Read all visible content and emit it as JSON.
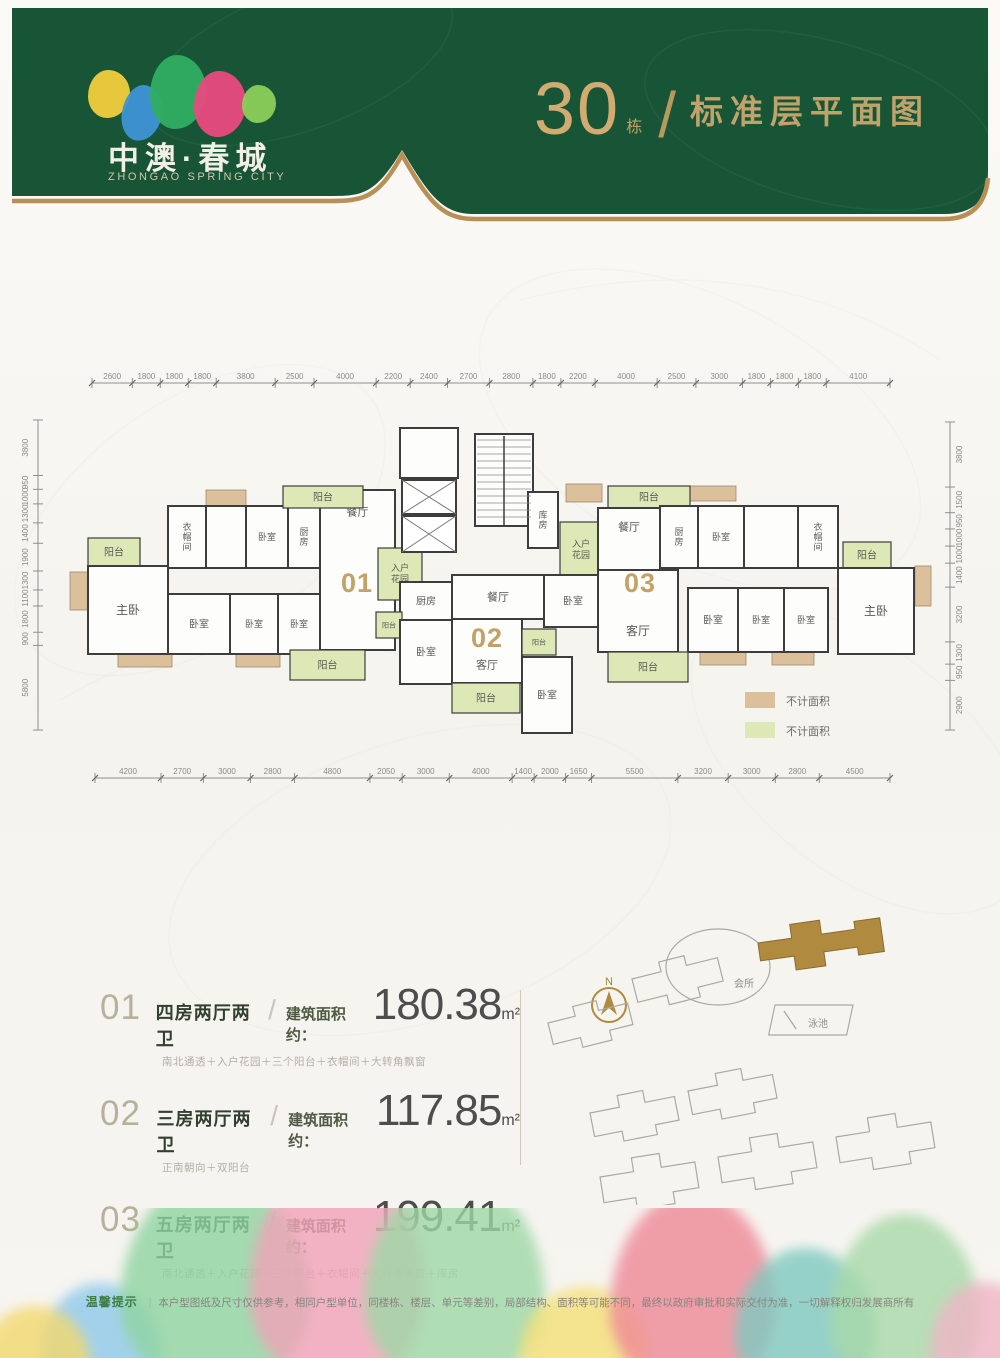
{
  "header": {
    "brand_cn": "中澳·春城",
    "brand_en": "ZHONGAO SPRING CITY",
    "building_number": "30",
    "building_suffix": "栋",
    "slash": "/",
    "page_title": "标准层平面图",
    "bg_color": "#175536",
    "gold_color": "#b89055",
    "leaf_colors": [
      "#f2cf3e",
      "#3e93d6",
      "#2fae62",
      "#e94a80",
      "#8ccf5a"
    ]
  },
  "plan": {
    "colors": {
      "tan": "#dcc09c",
      "green": "#dde8b6",
      "room": "#fdfdfb",
      "wall": "#3d3d3d",
      "dim": "#8f8f8f",
      "gold": "#c2a267"
    },
    "top_dims": [
      "2600",
      "1800",
      "1800",
      "1800",
      "3800",
      "2500",
      "4000",
      "2200",
      "2400",
      "2700",
      "2800",
      "1800",
      "2200",
      "4000",
      "2500",
      "3000",
      "1800",
      "1800",
      "1800",
      "4100"
    ],
    "bottom_dims": [
      "4200",
      "2700",
      "3000",
      "2800",
      "4800",
      "2050",
      "3000",
      "4000",
      "1400",
      "2000",
      "1650",
      "5500",
      "3200",
      "3000",
      "2800",
      "4500"
    ],
    "left_dims": [
      "3800",
      "950",
      "1000",
      "1300",
      "1400",
      "1900",
      "1300",
      "1100",
      "1800",
      "900",
      "5800"
    ],
    "right_dims": [
      "3800",
      "1500",
      "950",
      "1000",
      "1000",
      "1400",
      "3200",
      "1300",
      "950",
      "2900"
    ],
    "unit_numbers": [
      {
        "label": "01",
        "x": 357,
        "y": 232
      },
      {
        "label": "02",
        "x": 487,
        "y": 287
      },
      {
        "label": "03",
        "x": 640,
        "y": 232
      }
    ],
    "rooms": [
      {
        "x": 88,
        "y": 178,
        "w": 52,
        "h": 28,
        "f": "green",
        "label": "阳台",
        "fs": 10
      },
      {
        "x": 88,
        "y": 206,
        "w": 80,
        "h": 88,
        "f": "room",
        "label": "主卧",
        "fs": 12
      },
      {
        "x": 168,
        "y": 146,
        "w": 38,
        "h": 62,
        "f": "room",
        "label": "衣帽间",
        "fs": 9,
        "vert": true
      },
      {
        "x": 206,
        "y": 146,
        "w": 40,
        "h": 62,
        "f": "room"
      },
      {
        "x": 246,
        "y": 146,
        "w": 42,
        "h": 62,
        "f": "room",
        "label": "卧室",
        "fs": 9
      },
      {
        "x": 288,
        "y": 146,
        "w": 32,
        "h": 62,
        "f": "room",
        "label": "厨房",
        "fs": 9,
        "vert": true
      },
      {
        "x": 320,
        "y": 130,
        "w": 75,
        "h": 160,
        "f": "room",
        "label": "餐厅",
        "fs": 11,
        "ly": -58
      },
      {
        "x": 283,
        "y": 126,
        "w": 80,
        "h": 22,
        "f": "green",
        "label": "阳台",
        "fs": 10
      },
      {
        "x": 168,
        "y": 234,
        "w": 62,
        "h": 60,
        "f": "room",
        "label": "卧室",
        "fs": 10
      },
      {
        "x": 230,
        "y": 234,
        "w": 48,
        "h": 60,
        "f": "room",
        "label": "卧室",
        "fs": 9
      },
      {
        "x": 278,
        "y": 234,
        "w": 42,
        "h": 60,
        "f": "room",
        "label": "卧室",
        "fs": 9
      },
      {
        "x": 290,
        "y": 290,
        "w": 75,
        "h": 30,
        "f": "green",
        "label": "阳台",
        "fs": 10
      },
      {
        "x": 400,
        "y": 68,
        "w": 58,
        "h": 50,
        "f": "room"
      },
      {
        "x": 475,
        "y": 74,
        "w": 58,
        "h": 92,
        "f": "room"
      },
      {
        "x": 528,
        "y": 132,
        "w": 30,
        "h": 56,
        "f": "room",
        "label": "库房",
        "fs": 9,
        "vert": true
      },
      {
        "x": 378,
        "y": 188,
        "w": 44,
        "h": 52,
        "f": "green",
        "label": "入户花园",
        "fs": 9,
        "wrap": 2
      },
      {
        "x": 560,
        "y": 162,
        "w": 42,
        "h": 56,
        "f": "green",
        "label": "入户花园",
        "fs": 9,
        "wrap": 2
      },
      {
        "x": 400,
        "y": 222,
        "w": 52,
        "h": 38,
        "f": "room",
        "label": "厨房",
        "fs": 10
      },
      {
        "x": 376,
        "y": 252,
        "w": 26,
        "h": 26,
        "f": "green",
        "label": "阳台",
        "fs": 7
      },
      {
        "x": 452,
        "y": 215,
        "w": 92,
        "h": 44,
        "f": "room",
        "label": "餐厅",
        "fs": 11
      },
      {
        "x": 544,
        "y": 215,
        "w": 58,
        "h": 52,
        "f": "room",
        "label": "卧室",
        "fs": 10
      },
      {
        "x": 452,
        "y": 259,
        "w": 70,
        "h": 64,
        "f": "room",
        "label": "客厅",
        "fs": 11,
        "ly": 14
      },
      {
        "x": 400,
        "y": 260,
        "w": 52,
        "h": 64,
        "f": "room",
        "label": "卧室",
        "fs": 10
      },
      {
        "x": 452,
        "y": 323,
        "w": 68,
        "h": 30,
        "f": "green",
        "label": "阳台",
        "fs": 10
      },
      {
        "x": 522,
        "y": 297,
        "w": 50,
        "h": 76,
        "f": "room",
        "label": "卧室",
        "fs": 10
      },
      {
        "x": 522,
        "y": 269,
        "w": 34,
        "h": 26,
        "f": "green",
        "label": "阳台",
        "fs": 7
      },
      {
        "x": 608,
        "y": 126,
        "w": 82,
        "h": 22,
        "f": "green",
        "label": "阳台",
        "fs": 10
      },
      {
        "x": 598,
        "y": 148,
        "w": 62,
        "h": 62,
        "f": "room",
        "label": "餐厅",
        "fs": 11,
        "ly": -12
      },
      {
        "x": 660,
        "y": 146,
        "w": 38,
        "h": 62,
        "f": "room",
        "label": "厨房",
        "fs": 9,
        "vert": true
      },
      {
        "x": 698,
        "y": 146,
        "w": 46,
        "h": 62,
        "f": "room",
        "label": "卧室",
        "fs": 9
      },
      {
        "x": 744,
        "y": 146,
        "w": 54,
        "h": 62,
        "f": "room"
      },
      {
        "x": 798,
        "y": 146,
        "w": 40,
        "h": 62,
        "f": "room",
        "label": "衣帽间",
        "fs": 9,
        "vert": true
      },
      {
        "x": 598,
        "y": 210,
        "w": 80,
        "h": 82,
        "f": "room",
        "label": "客厅",
        "fs": 12,
        "ly": 20
      },
      {
        "x": 688,
        "y": 228,
        "w": 50,
        "h": 64,
        "f": "room",
        "label": "卧室",
        "fs": 10
      },
      {
        "x": 738,
        "y": 228,
        "w": 46,
        "h": 64,
        "f": "room",
        "label": "卧室",
        "fs": 9
      },
      {
        "x": 784,
        "y": 228,
        "w": 44,
        "h": 64,
        "f": "room",
        "label": "卧室",
        "fs": 9
      },
      {
        "x": 608,
        "y": 292,
        "w": 80,
        "h": 30,
        "f": "green",
        "label": "阳台",
        "fs": 10
      },
      {
        "x": 843,
        "y": 182,
        "w": 48,
        "h": 26,
        "f": "green",
        "label": "阳台",
        "fs": 10
      },
      {
        "x": 838,
        "y": 208,
        "w": 76,
        "h": 86,
        "f": "room",
        "label": "主卧",
        "fs": 12
      }
    ],
    "bays": [
      {
        "x": 70,
        "y": 212,
        "w": 18,
        "h": 38
      },
      {
        "x": 206,
        "y": 130,
        "w": 40,
        "h": 16
      },
      {
        "x": 366,
        "y": 132,
        "w": 28,
        "h": 40
      },
      {
        "x": 118,
        "y": 294,
        "w": 54,
        "h": 13
      },
      {
        "x": 236,
        "y": 294,
        "w": 44,
        "h": 13
      },
      {
        "x": 404,
        "y": 70,
        "w": 50,
        "h": 14
      },
      {
        "x": 566,
        "y": 124,
        "w": 36,
        "h": 18
      },
      {
        "x": 690,
        "y": 126,
        "w": 46,
        "h": 15
      },
      {
        "x": 915,
        "y": 206,
        "w": 16,
        "h": 40
      },
      {
        "x": 700,
        "y": 292,
        "w": 46,
        "h": 13
      },
      {
        "x": 772,
        "y": 292,
        "w": 42,
        "h": 13
      }
    ],
    "legend": [
      {
        "swatch": "tan",
        "label": "不计面积"
      },
      {
        "swatch": "green",
        "label": "不计面积"
      }
    ]
  },
  "units_info": {
    "rows": [
      {
        "no": "01",
        "type": "四房两厅两卫",
        "slash": "/",
        "area_prefix": "建筑面积约：",
        "area": "180.38",
        "area_unit": "m²",
        "features": "南北通透＋入户花园＋三个阳台＋衣帽间＋大转角飘窗"
      },
      {
        "no": "02",
        "type": "三房两厅两卫",
        "slash": "/",
        "area_prefix": "建筑面积约：",
        "area": "117.85",
        "area_unit": "m²",
        "features": "正南朝向＋双阳台"
      },
      {
        "no": "03",
        "type": "五房两厅两卫",
        "slash": "/",
        "area_prefix": "建筑面积约：",
        "area": "199.41",
        "area_unit": "m²",
        "features": "南北通透＋入户花园＋三个阳台＋衣帽间＋大转角飘窗＋库房"
      }
    ]
  },
  "site_map": {
    "north_label": "N",
    "club_label": "会所",
    "pool_label": "泳池",
    "highlight_color": "#b08a3e",
    "outline_color": "#a9a9a5"
  },
  "footer": {
    "notice_label": "温馨提示",
    "notice_sep": "｜",
    "notice_text": "本户型图纸及尺寸仅供参考，相同户型单位，同楼栋、楼层、单元等差别，局部结构、面积等可能不同，最终以政府审批和实际交付为准，一切解释权归发展商所有",
    "tree_colors": [
      "#8fc9ea",
      "#8fd4a0",
      "#f2a2b8",
      "#9ed8a6",
      "#f4e077",
      "#ee8997",
      "#7fc9c0",
      "#f0b5c6",
      "#a8d9a8",
      "#f3d96e"
    ]
  }
}
